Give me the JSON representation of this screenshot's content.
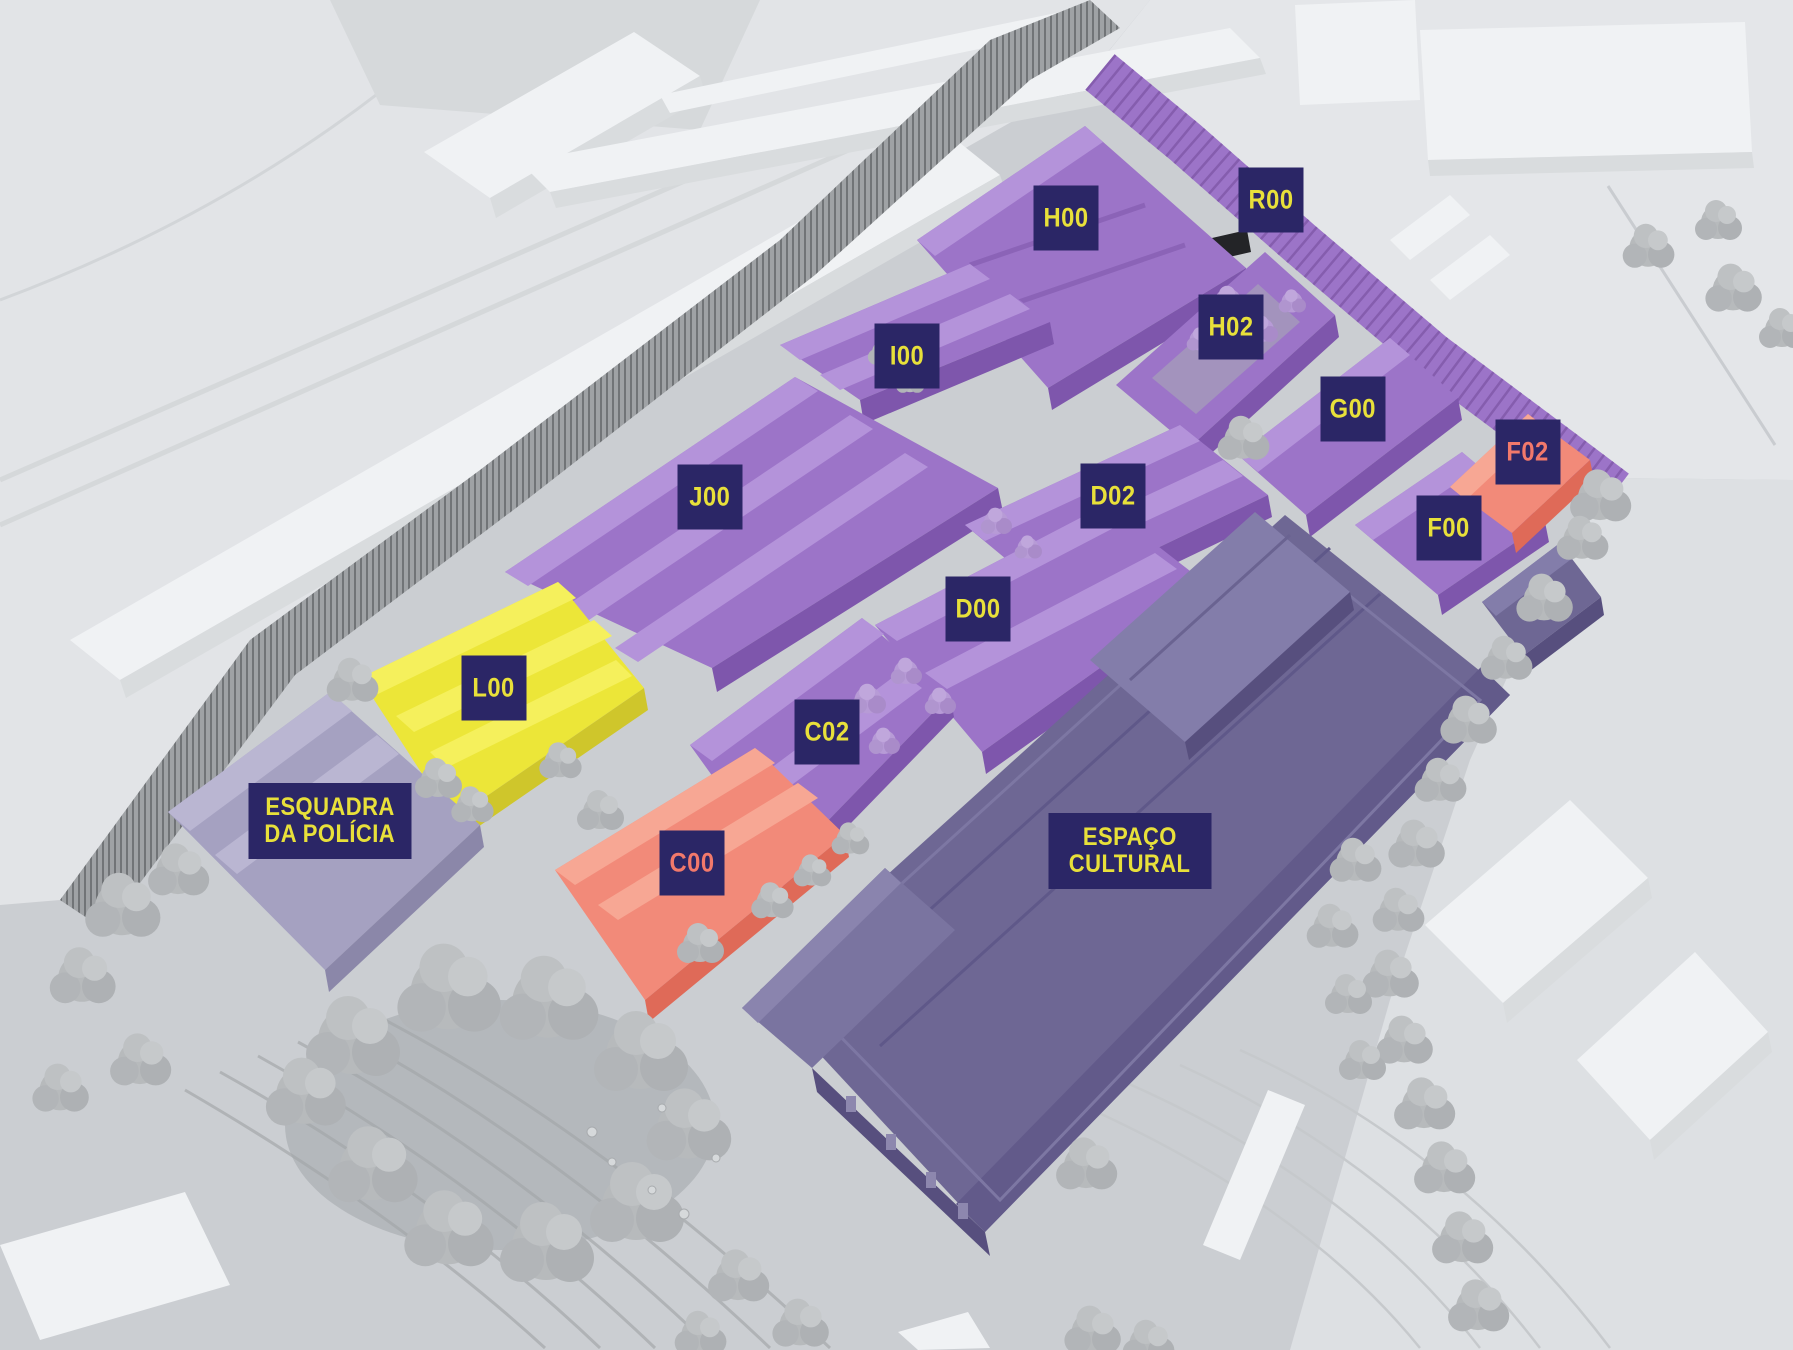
{
  "palette": {
    "highlight_purple": "#9c74c8",
    "highlight_purple_light": "#b493da",
    "highlight_purple_dark": "#7e56ac",
    "highlight_yellow": "#ece638",
    "highlight_salmon": "#f28a79",
    "cultural_slate": "#6e6794",
    "police_lavender": "#a5a1c1",
    "chip_background": "#2b2666",
    "chip_text_yellow": "#e8e03a",
    "chip_text_salmon": "#f2796b",
    "ground_gray": "#cbced2",
    "context_light": "#e3e5e8",
    "context_white": "#f0f2f4",
    "tree_gray": "#b7babc",
    "tree_lilac": "#b79bd6"
  },
  "labels": {
    "h00": {
      "text": "H00"
    },
    "r00": {
      "text": "R00"
    },
    "h02": {
      "text": "H02"
    },
    "i00": {
      "text": "I00"
    },
    "g00": {
      "text": "G00"
    },
    "f02": {
      "text": "F02"
    },
    "f00": {
      "text": "F00"
    },
    "j00": {
      "text": "J00"
    },
    "d02": {
      "text": "D02"
    },
    "d00": {
      "text": "D00"
    },
    "l00": {
      "text": "L00"
    },
    "c02": {
      "text": "C02"
    },
    "c00": {
      "text": "C00"
    },
    "espaco_cultural": {
      "line1": "ESPAÇO",
      "line2": "CULTURAL"
    },
    "esquadra_policia": {
      "line1": "ESQUADRA",
      "line2": "DA POLÍCIA"
    }
  }
}
